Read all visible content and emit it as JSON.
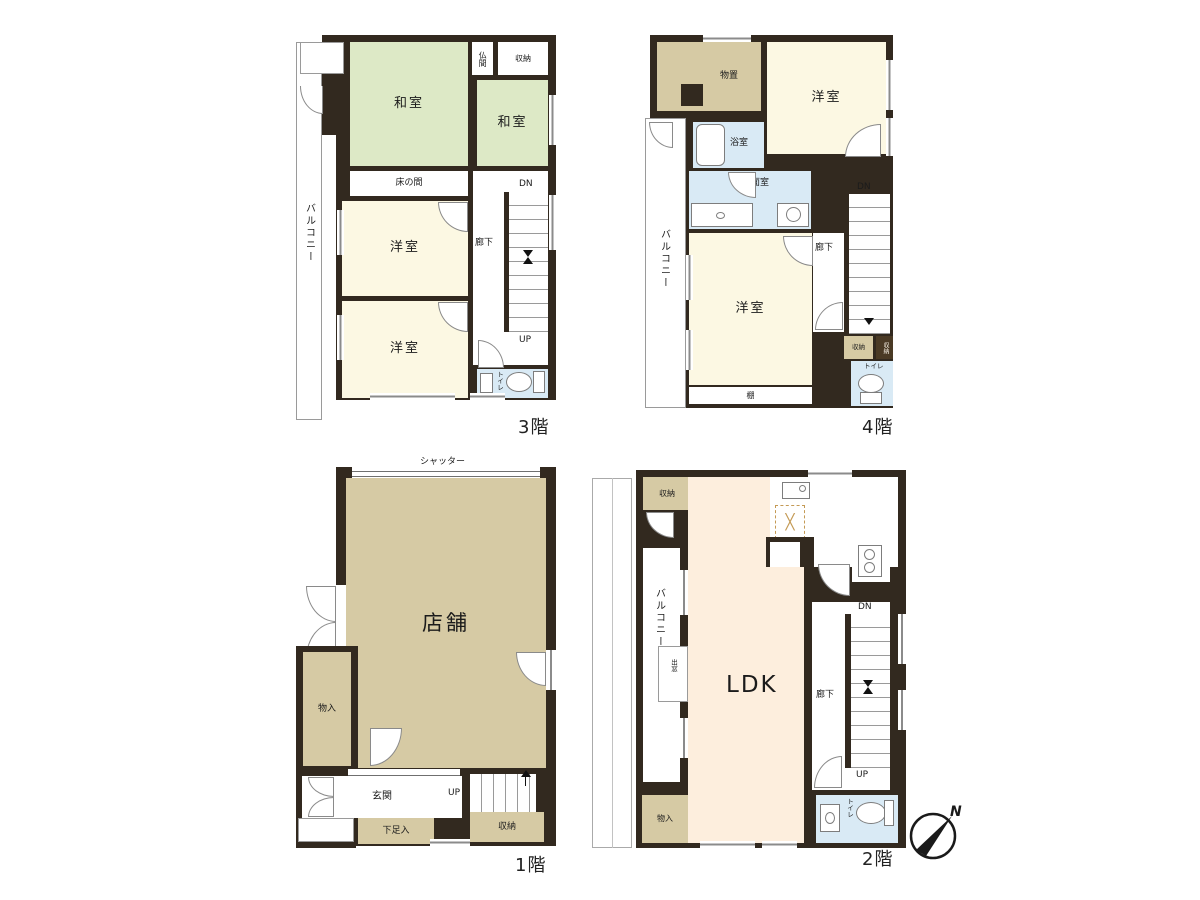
{
  "colors": {
    "wall": "#32291f",
    "tatami_green": "#dde9c6",
    "western_cream": "#fcf8e3",
    "storage_tan": "#d6caa4",
    "wet_area_blue": "#d9eaf5",
    "ldk_peach": "#fdeedd"
  },
  "floor_plans": {
    "f3": {
      "floor_label": "3階",
      "balcony": "バルコニー",
      "washitsu_large": "和室",
      "butsuma": "仏間",
      "shuno": "収納",
      "washitsu_small": "和室",
      "tokonoma": "床の間",
      "yoshitsu_a": "洋室",
      "yoshitsu_b": "洋室",
      "roka": "廊下",
      "dn": "DN",
      "up": "UP",
      "toilet": "トイレ"
    },
    "f4": {
      "floor_label": "4階",
      "monooki": "物置",
      "yoshitsu_a": "洋室",
      "yokushitsu": "浴室",
      "senmenshitsu": "洗面室",
      "balcony": "バルコニー",
      "yoshitsu_b": "洋室",
      "tana": "棚",
      "roka": "廊下",
      "dn": "DN",
      "shuno_a": "収納",
      "shuno_b": "収納",
      "toilet": "トイレ"
    },
    "f1": {
      "floor_label": "1階",
      "shutter": "シャッター",
      "tenpo": "店舗",
      "monoire": "物入",
      "genkan": "玄関",
      "geta_bako": "下足入",
      "up": "UP",
      "shuno": "収納"
    },
    "f2": {
      "floor_label": "2階",
      "shuno": "収納",
      "ldk": "LDK",
      "balcony": "バルコニー",
      "demado": "出窓",
      "roka": "廊下",
      "dn": "DN",
      "up": "UP",
      "toilet": "トイレ",
      "monoire": "物入"
    }
  },
  "compass": {
    "north": "N"
  }
}
